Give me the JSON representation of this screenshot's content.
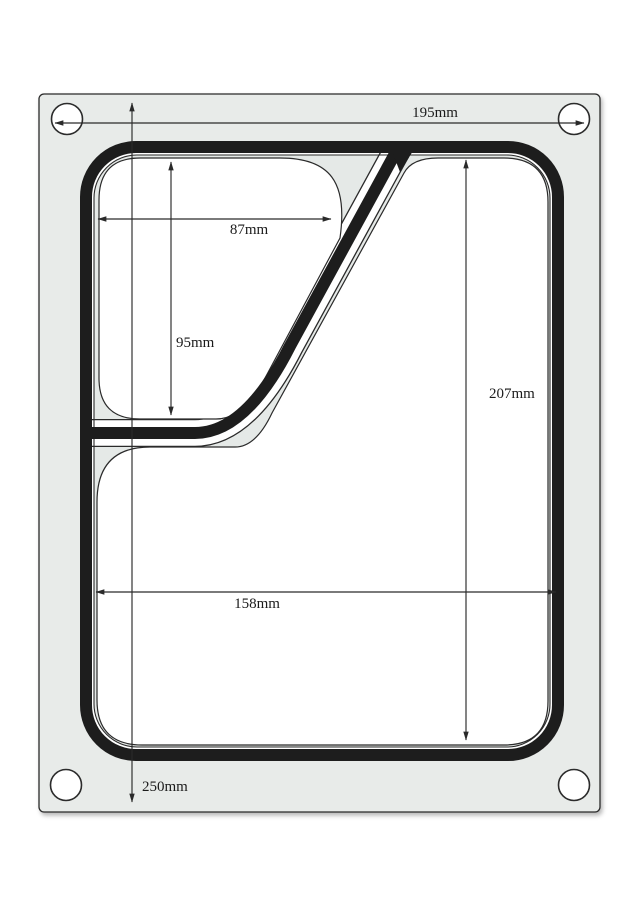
{
  "drawing": {
    "type": "sealing-matrix-technical-drawing",
    "dimensions": {
      "plate_width": "195mm",
      "small_compartment_width": "87mm",
      "small_compartment_height": "95mm",
      "large_compartment_height": "207mm",
      "large_compartment_width": "158mm",
      "plate_height": "250mm"
    }
  },
  "colors": {
    "plate_fill": "#e8ebe9",
    "flange_fill": "#e5e9e7",
    "cavity_fill": "#ffffff",
    "seal_line": "#1d1d1d",
    "thin_line": "#2a2a2a",
    "dim_line": "#2a2a2a"
  }
}
